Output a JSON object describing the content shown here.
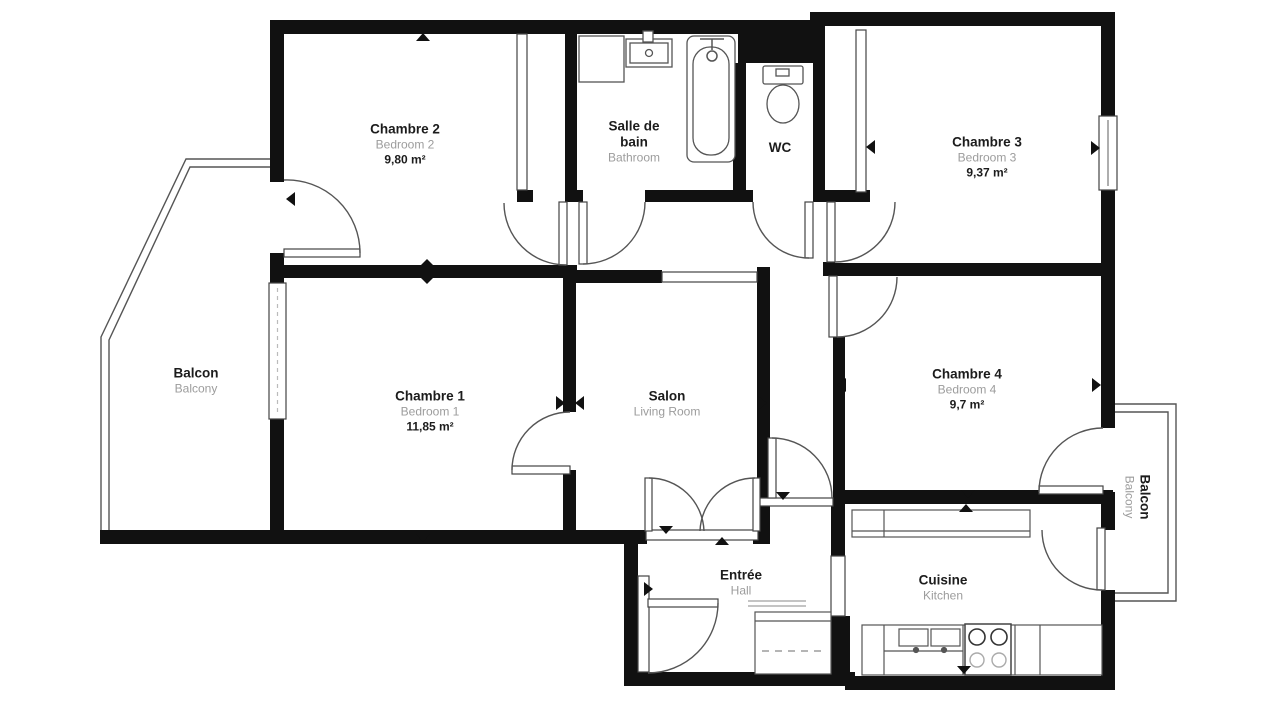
{
  "plan": {
    "background_color": "#ffffff",
    "wall_color": "#111111",
    "line_color": "#555555",
    "rooms": [
      {
        "id": "chambre-2",
        "name": "Chambre 2",
        "name_en": "Bedroom 2",
        "area": "9,80 m²"
      },
      {
        "id": "salle-de-bain",
        "name": "Salle de bain",
        "name_en": "Bathroom",
        "area": ""
      },
      {
        "id": "wc",
        "name": "WC",
        "name_en": "",
        "area": ""
      },
      {
        "id": "chambre-3",
        "name": "Chambre 3",
        "name_en": "Bedroom 3",
        "area": "9,37 m²"
      },
      {
        "id": "balcon-gauche",
        "name": "Balcon",
        "name_en": "Balcony",
        "area": ""
      },
      {
        "id": "chambre-1",
        "name": "Chambre 1",
        "name_en": "Bedroom 1",
        "area": "11,85 m²"
      },
      {
        "id": "salon",
        "name": "Salon",
        "name_en": "Living Room",
        "area": ""
      },
      {
        "id": "chambre-4",
        "name": "Chambre 4",
        "name_en": "Bedroom 4",
        "area": "9,7 m²"
      },
      {
        "id": "balcon-droit",
        "name": "Balcon",
        "name_en": "Balcony",
        "area": ""
      },
      {
        "id": "entree",
        "name": "Entrée",
        "name_en": "Hall",
        "area": ""
      },
      {
        "id": "cuisine",
        "name": "Cuisine",
        "name_en": "Kitchen",
        "area": ""
      }
    ],
    "fixtures": [
      "bathtub",
      "shower-head",
      "bathroom-sink",
      "washing-machine",
      "toilet",
      "kitchen-sink",
      "stove",
      "kitchen-counter",
      "upper-cabinets",
      "wardrobe"
    ]
  }
}
